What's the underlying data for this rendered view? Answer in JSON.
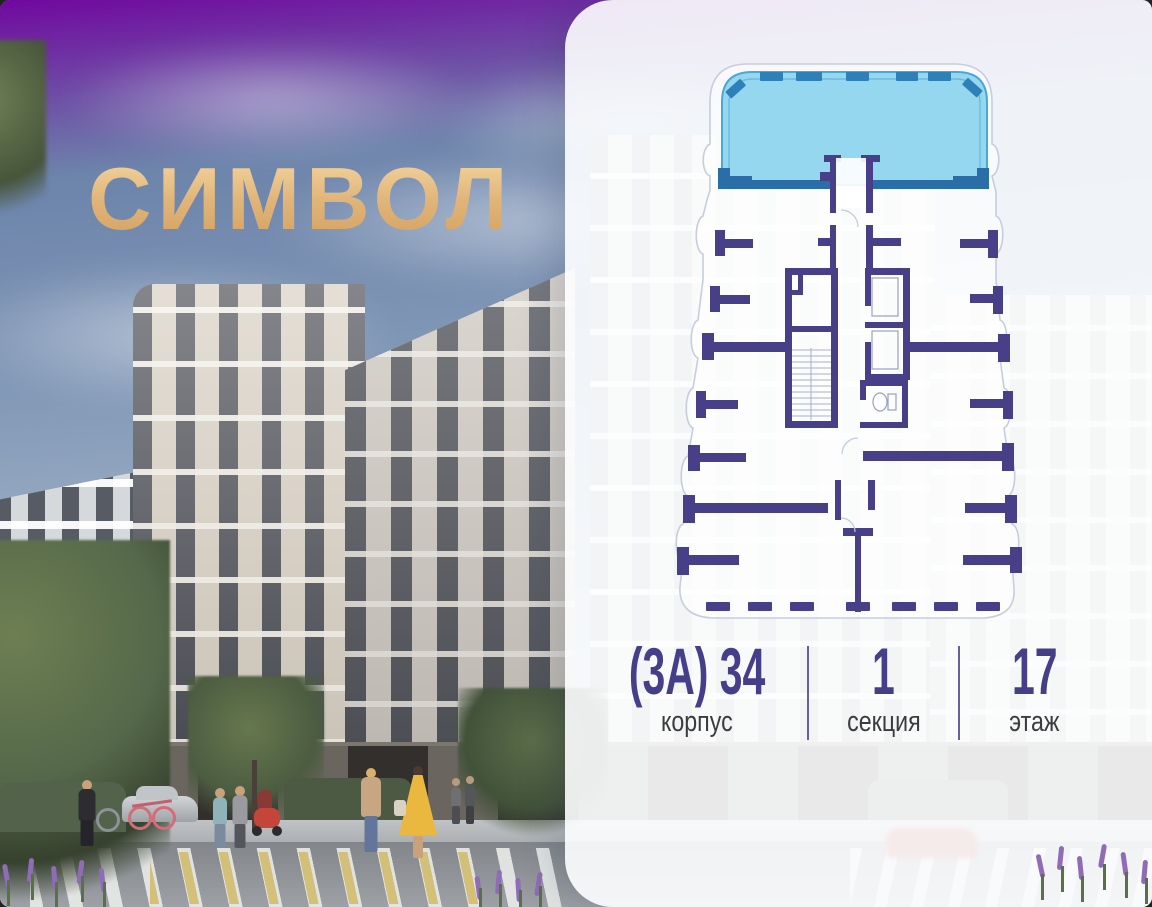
{
  "logo": {
    "text": "СИМВОЛ",
    "color": "#e6c084"
  },
  "unit_info": {
    "items": [
      {
        "value": "(3А) 34",
        "label": "корпус"
      },
      {
        "value": "1",
        "label": "секция"
      },
      {
        "value": "17",
        "label": "этаж"
      }
    ]
  },
  "floor_plan": {
    "type": "apartment-floor-plan",
    "highlight_fill": "#8dd4ef",
    "highlight_window_color": "#2e80b9",
    "highlight_wall_color": "#2b6da7",
    "wall_color": "#474088",
    "outline_color": "#c6cddd"
  },
  "colors": {
    "accent_purple": "#474088",
    "number_color": "#453f8a",
    "label_color": "#3c3c40",
    "logo_gold": "#e6c084",
    "panel_white": "rgba(253,254,255,0.9)"
  }
}
